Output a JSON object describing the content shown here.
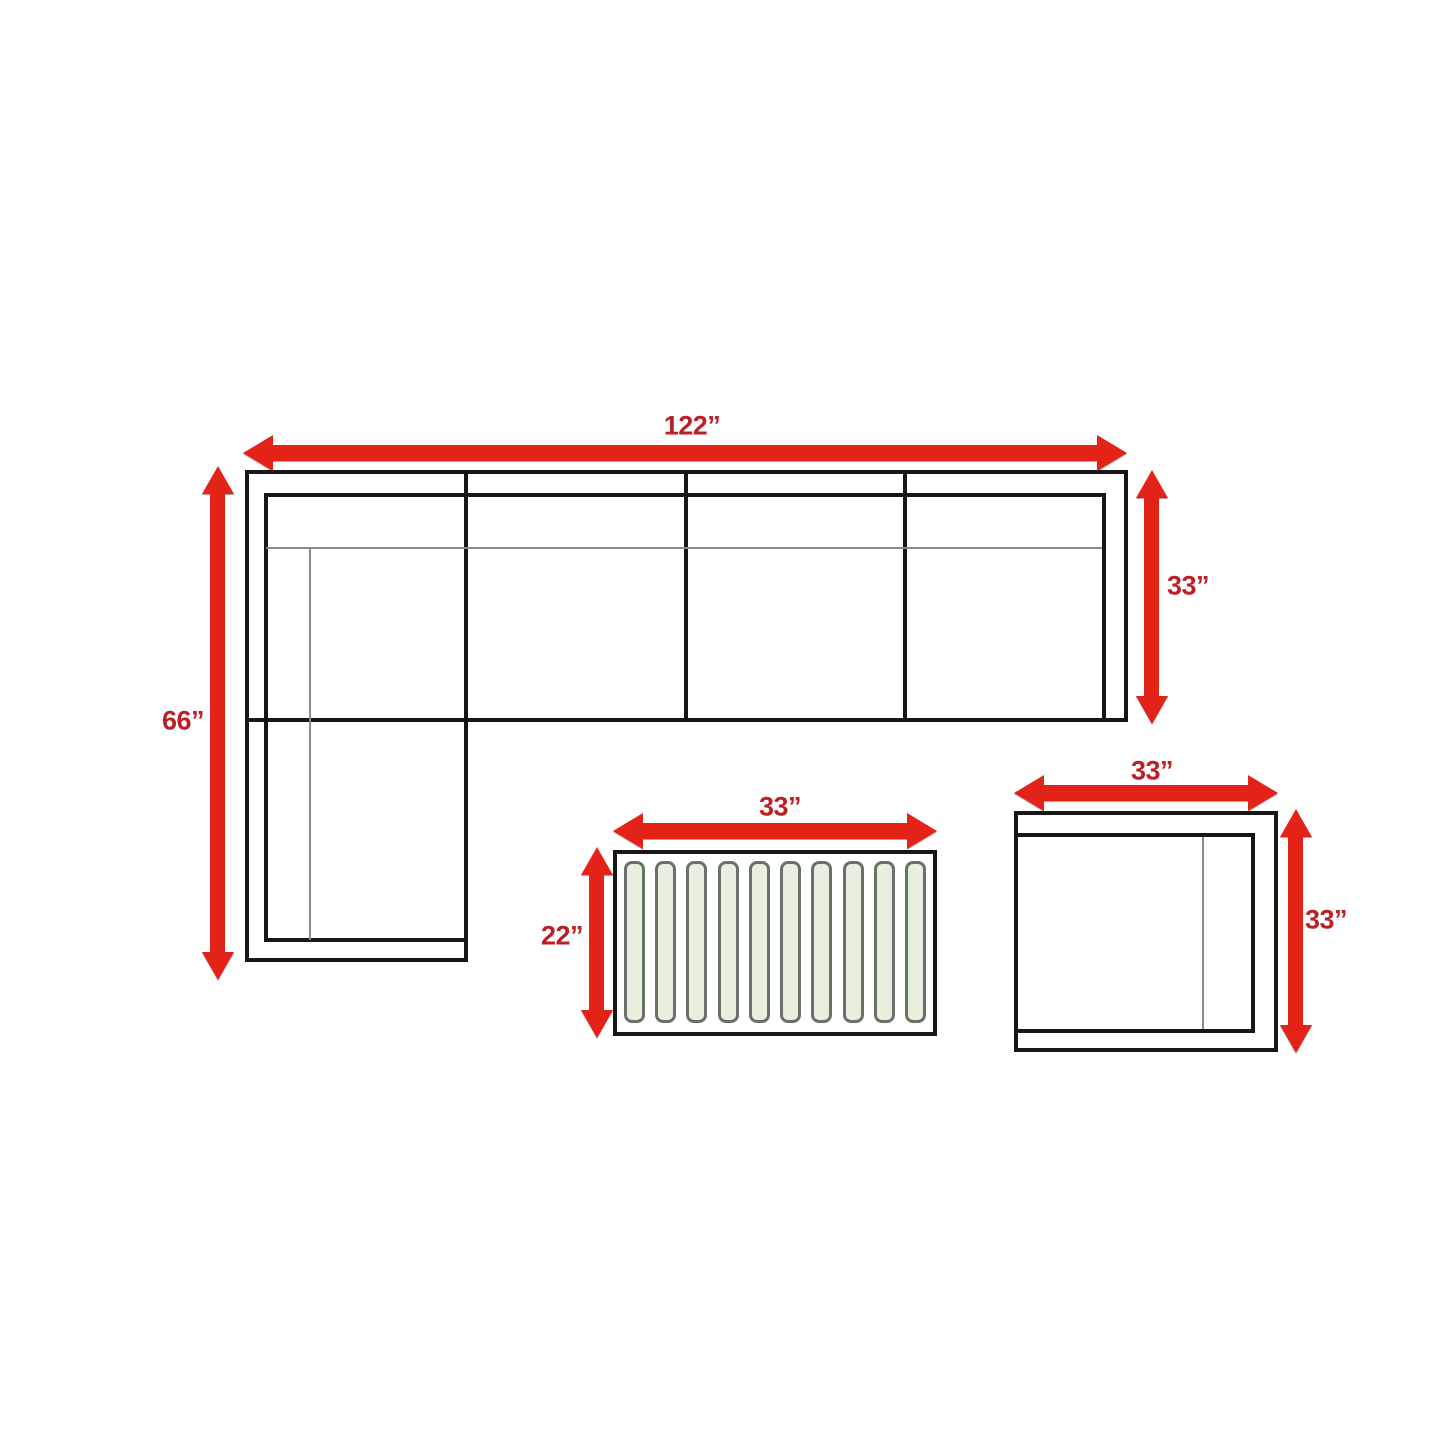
{
  "canvas": {
    "width": 1445,
    "height": 1445,
    "background": "#ffffff"
  },
  "colors": {
    "arrow_red": "#e42318",
    "label_red": "#bc2026",
    "outline_black": "#171717",
    "thin_gray": "#8a8a8a",
    "slat_fill": "#e7f0df",
    "slat_border": "#69726a"
  },
  "sofa": {
    "width_label": "122”",
    "chaise_label": "66”",
    "depth_label": "33”",
    "seat_sections": 4
  },
  "coffee_table": {
    "width_label": "33”",
    "depth_label": "22”",
    "slat_count": 10
  },
  "chair": {
    "width_label": "33”",
    "depth_label": "33”"
  }
}
